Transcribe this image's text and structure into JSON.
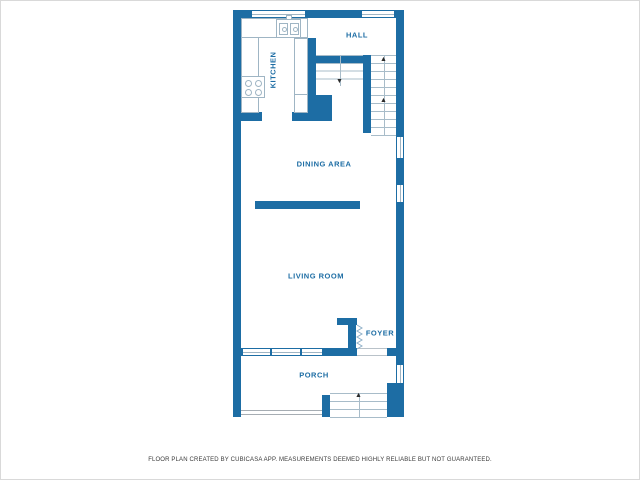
{
  "plan": {
    "rooms": {
      "kitchen": "KITCHEN",
      "hall": "HALL",
      "dining_area": "DINING AREA",
      "living_room": "LIVING ROOM",
      "foyer": "FOYER",
      "porch": "PORCH"
    },
    "icons": {
      "stairs_up_arrow": "▲",
      "stairs_down_arrow": "▼"
    },
    "footer_disclaimer": "FLOOR PLAN CREATED BY CUBICASA APP. MEASUREMENTS DEEMED HIGHLY RELIABLE BUT NOT GUARANTEED.",
    "colors": {
      "wall": "#1d6da4",
      "label_text": "#1d6da4",
      "fixture_line": "#9fb5c4",
      "stair_line": "#a8bcc9",
      "arrow": "#2b2b2b",
      "floor": "#ffffff",
      "footer_text": "#3a3a3a",
      "page_border": "#d9d9d9"
    }
  }
}
